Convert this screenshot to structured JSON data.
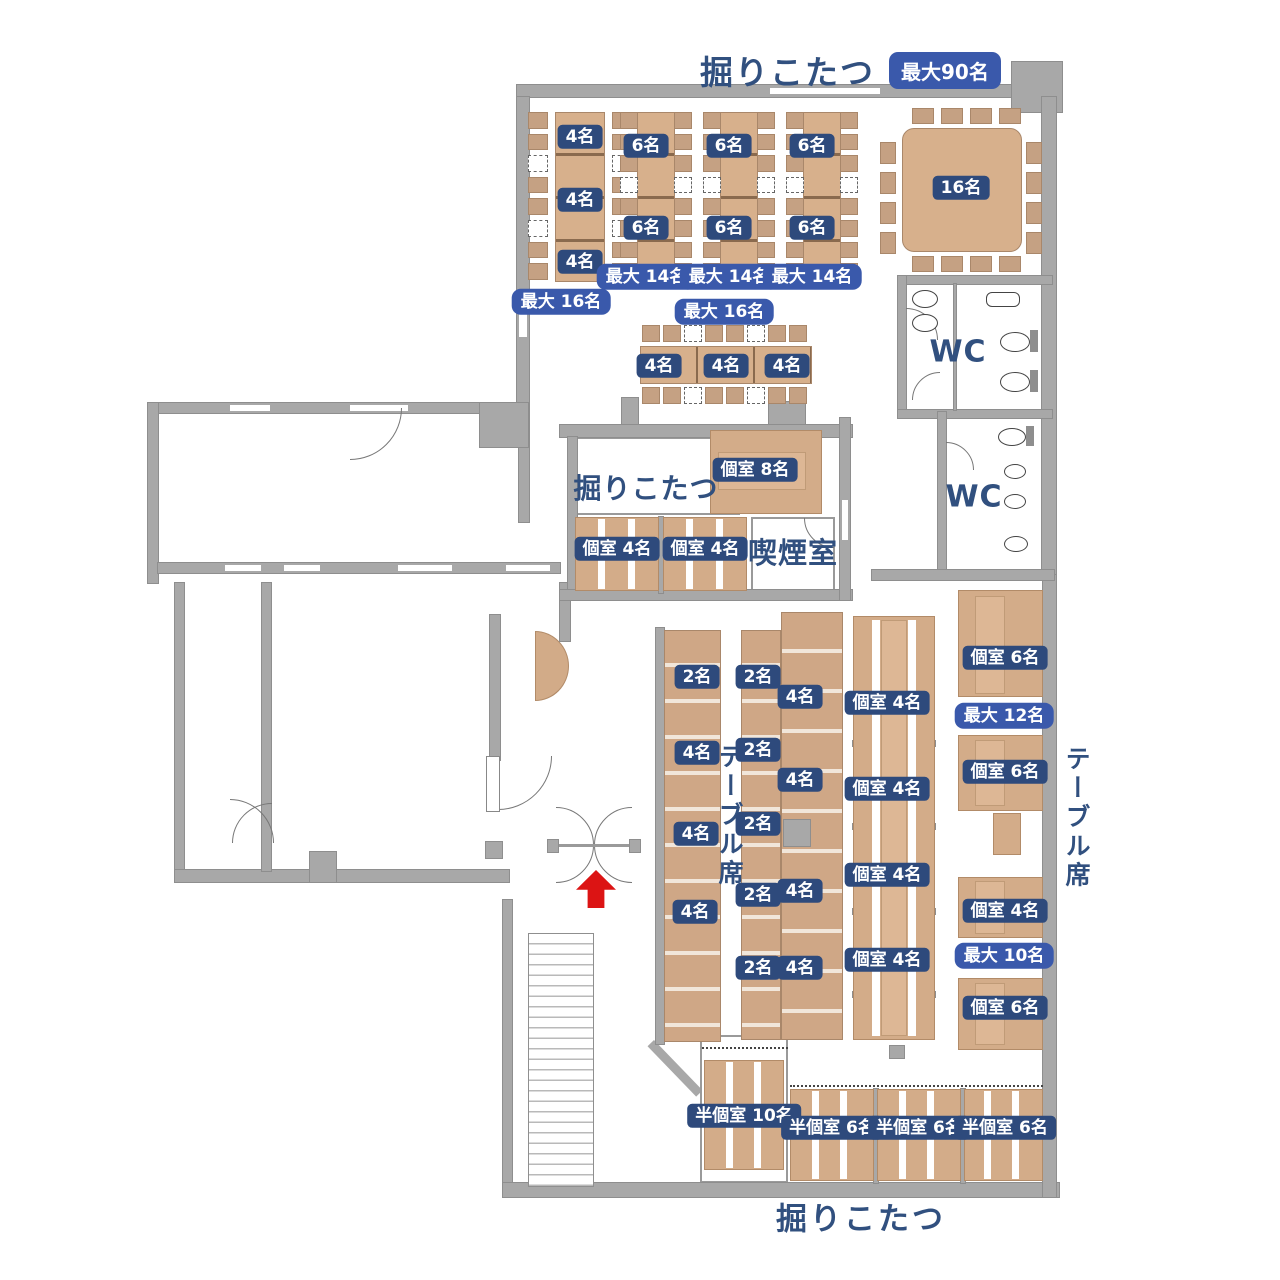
{
  "title_top": {
    "text": "掘りこたつ",
    "badge": "最大90名"
  },
  "title_bottom": {
    "text": "掘りこたつ"
  },
  "area_labels": [
    {
      "text": "掘りこたつ",
      "x": 646,
      "y": 487,
      "size": 28,
      "vertical": false
    },
    {
      "text": "喫煙室",
      "x": 793,
      "y": 551,
      "size": 29,
      "vertical": false
    },
    {
      "text": "WC",
      "x": 958,
      "y": 352,
      "size": 30,
      "vertical": false
    },
    {
      "text": "WC",
      "x": 974,
      "y": 497,
      "size": 30,
      "vertical": false
    },
    {
      "text": "テーブル席",
      "x": 729,
      "y": 816,
      "size": 25,
      "vertical": true
    },
    {
      "text": "テーブル席",
      "x": 1076,
      "y": 818,
      "size": 25,
      "vertical": true
    }
  ],
  "seat_badges": [
    {
      "text": "4名",
      "x": 580,
      "y": 137,
      "style": "navy"
    },
    {
      "text": "4名",
      "x": 580,
      "y": 200,
      "style": "navy"
    },
    {
      "text": "4名",
      "x": 580,
      "y": 262,
      "style": "navy"
    },
    {
      "text": "最大 16名",
      "x": 561,
      "y": 302,
      "style": "blue"
    },
    {
      "text": "6名",
      "x": 646,
      "y": 146,
      "style": "navy"
    },
    {
      "text": "6名",
      "x": 646,
      "y": 228,
      "style": "navy"
    },
    {
      "text": "最大 14名",
      "x": 646,
      "y": 277,
      "style": "blue"
    },
    {
      "text": "6名",
      "x": 729,
      "y": 146,
      "style": "navy"
    },
    {
      "text": "6名",
      "x": 729,
      "y": 228,
      "style": "navy"
    },
    {
      "text": "最大 14名",
      "x": 729,
      "y": 277,
      "style": "blue"
    },
    {
      "text": "6名",
      "x": 812,
      "y": 146,
      "style": "navy"
    },
    {
      "text": "6名",
      "x": 812,
      "y": 228,
      "style": "navy"
    },
    {
      "text": "最大 14名",
      "x": 812,
      "y": 277,
      "style": "blue"
    },
    {
      "text": "16名",
      "x": 961,
      "y": 188,
      "style": "navy"
    },
    {
      "text": "最大 16名",
      "x": 724,
      "y": 312,
      "style": "blue"
    },
    {
      "text": "4名",
      "x": 659,
      "y": 366,
      "style": "navy"
    },
    {
      "text": "4名",
      "x": 726,
      "y": 366,
      "style": "navy"
    },
    {
      "text": "4名",
      "x": 787,
      "y": 366,
      "style": "navy"
    },
    {
      "text": "個室 8名",
      "x": 755,
      "y": 470,
      "style": "navy"
    },
    {
      "text": "個室 4名",
      "x": 617,
      "y": 549,
      "style": "navy"
    },
    {
      "text": "個室 4名",
      "x": 705,
      "y": 549,
      "style": "navy"
    },
    {
      "text": "2名",
      "x": 697,
      "y": 677,
      "style": "navy"
    },
    {
      "text": "4名",
      "x": 697,
      "y": 753,
      "style": "navy"
    },
    {
      "text": "4名",
      "x": 696,
      "y": 834,
      "style": "navy"
    },
    {
      "text": "4名",
      "x": 695,
      "y": 912,
      "style": "navy"
    },
    {
      "text": "2名",
      "x": 758,
      "y": 677,
      "style": "navy"
    },
    {
      "text": "2名",
      "x": 758,
      "y": 750,
      "style": "navy"
    },
    {
      "text": "2名",
      "x": 758,
      "y": 824,
      "style": "navy"
    },
    {
      "text": "2名",
      "x": 758,
      "y": 895,
      "style": "navy"
    },
    {
      "text": "2名",
      "x": 758,
      "y": 968,
      "style": "navy"
    },
    {
      "text": "4名",
      "x": 800,
      "y": 697,
      "style": "navy"
    },
    {
      "text": "4名",
      "x": 800,
      "y": 780,
      "style": "navy"
    },
    {
      "text": "4名",
      "x": 800,
      "y": 891,
      "style": "navy"
    },
    {
      "text": "4名",
      "x": 800,
      "y": 968,
      "style": "navy"
    },
    {
      "text": "個室 4名",
      "x": 887,
      "y": 703,
      "style": "navy"
    },
    {
      "text": "個室 4名",
      "x": 887,
      "y": 789,
      "style": "navy"
    },
    {
      "text": "個室 4名",
      "x": 887,
      "y": 875,
      "style": "navy"
    },
    {
      "text": "個室 4名",
      "x": 887,
      "y": 960,
      "style": "navy"
    },
    {
      "text": "個室 6名",
      "x": 1005,
      "y": 658,
      "style": "navy"
    },
    {
      "text": "最大 12名",
      "x": 1004,
      "y": 716,
      "style": "blue"
    },
    {
      "text": "個室 6名",
      "x": 1005,
      "y": 772,
      "style": "navy"
    },
    {
      "text": "個室 4名",
      "x": 1005,
      "y": 911,
      "style": "navy"
    },
    {
      "text": "最大 10名",
      "x": 1004,
      "y": 956,
      "style": "blue"
    },
    {
      "text": "個室 6名",
      "x": 1005,
      "y": 1008,
      "style": "navy"
    },
    {
      "text": "半個室 10名",
      "x": 744,
      "y": 1116,
      "style": "navy"
    },
    {
      "text": "半個室 6名",
      "x": 832,
      "y": 1128,
      "style": "navy"
    },
    {
      "text": "半個室 6名",
      "x": 919,
      "y": 1128,
      "style": "navy"
    },
    {
      "text": "半個室 6名",
      "x": 1005,
      "y": 1128,
      "style": "navy"
    }
  ],
  "colors": {
    "badge_navy": "#2e4a7c",
    "badge_blue": "#3a59ab",
    "text_navy": "#31507f",
    "wood": "#d3ac89",
    "wall_gray": "#a8a8a8",
    "arrow_red": "#dc1414"
  }
}
